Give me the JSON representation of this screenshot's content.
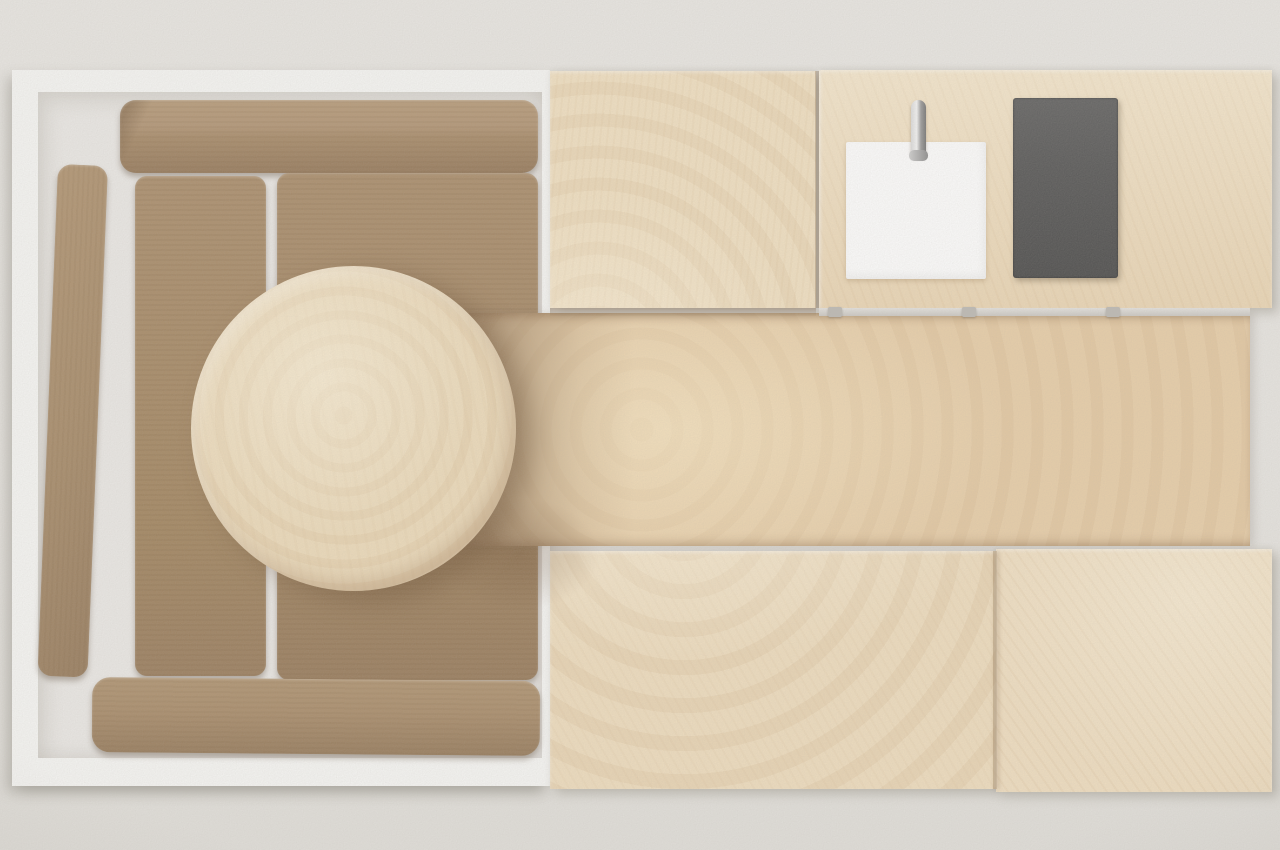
{
  "scene": {
    "type": "3d-render-top-view",
    "description": "Top-down view of a compact interior: corner sofa on a white platform with a round wooden coffee table on the left, and a wooden kitchenette with sink, chrome faucet and dark cooktop arranged around a wooden floor aisle on the right.",
    "background_color": "#e8e6e2"
  },
  "sofa": {
    "platform_color": "#f8f8f6",
    "inner_floor_color": "#eceae7",
    "cushion_base_color": "#a58866",
    "cushion_highlight_color": "#b79b79",
    "cushion_shadow_color": "#8c7355",
    "cushions": [
      "backrest-top",
      "armrest-left",
      "seat-left",
      "seat-right",
      "backrest-bottom"
    ]
  },
  "coffee_table": {
    "shape": "round",
    "wood_color": "#eedcbb",
    "grain": "concentric-rings"
  },
  "kitchen": {
    "counters": [
      "top-left",
      "top-right",
      "bottom-left",
      "bottom-right"
    ],
    "counter_wood_color": "#f1dfc0",
    "floor_aisle_color": "#e9cfa9",
    "sink": {
      "shape": "square",
      "color": "#ffffff"
    },
    "faucet": {
      "finish": "chrome",
      "color": "#b9b9b9"
    },
    "cooktop": {
      "shape": "rectangle",
      "color": "#515151"
    },
    "hinge_color": "#bdbab5",
    "hinge_count": 3
  },
  "lighting": {
    "table_shadow_color": "rgba(96,66,38,0.42)",
    "vignette": true,
    "grain_overlay": true
  }
}
